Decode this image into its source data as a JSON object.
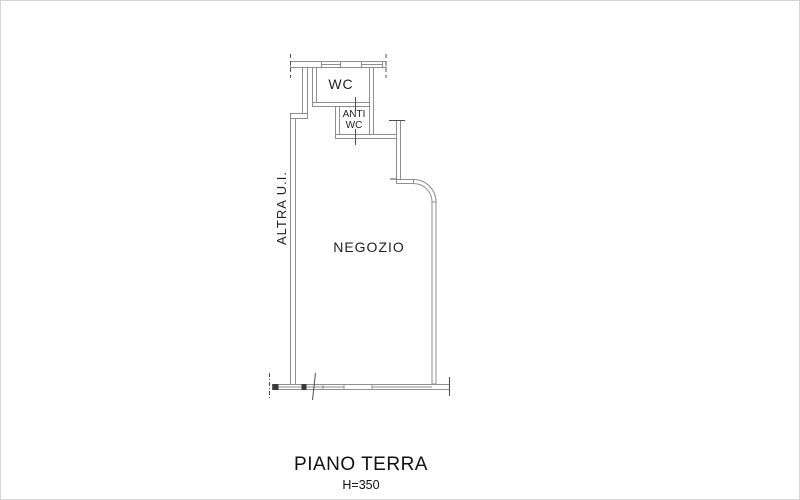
{
  "drawing": {
    "type": "floor-plan",
    "floor_title": "PIANO TERRA",
    "height_note": "H=350"
  },
  "labels": {
    "wc": "WC",
    "anti_wc_line1": "ANTI",
    "anti_wc_line2": "WC",
    "negozio": "NEGOZIO",
    "altra_ui": "ALTRA U.I."
  },
  "colors": {
    "wall_line": "#8f8f8f",
    "tick_line": "#4f4f4f",
    "pier_fill": "#3a3a3a",
    "text": "#222222",
    "background": "#ffffff",
    "frame_border": "#d6d6d6"
  }
}
